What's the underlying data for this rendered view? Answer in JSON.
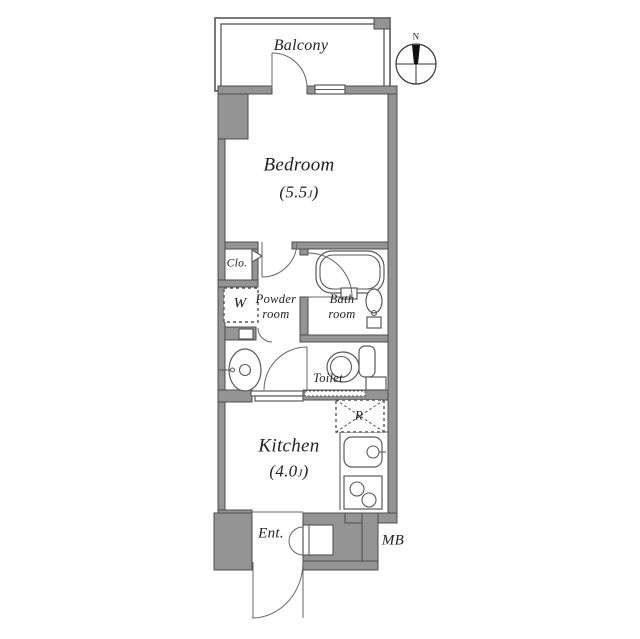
{
  "colors": {
    "wall": "#949494",
    "line": "#4d4d4d",
    "fixture": "#5a5a5a",
    "door": "#666666",
    "text": "#222222",
    "background": "#ffffff"
  },
  "compass": {
    "north_label": "N"
  },
  "rooms": {
    "balcony": {
      "label": "Balcony"
    },
    "bedroom": {
      "label": "Bedroom",
      "size_prefix": "(5.5",
      "size_unit": "J",
      "size_suffix": ")"
    },
    "closet": {
      "label": "Clo."
    },
    "washing_machine": {
      "label": "W"
    },
    "powder_room": {
      "label_line1": "Powder",
      "label_line2": "room"
    },
    "bath_room": {
      "label_line1": "Bath",
      "label_line2": "room"
    },
    "toilet": {
      "label": "Toilet"
    },
    "kitchen": {
      "label": "Kitchen",
      "size_prefix": "(4.0",
      "size_unit": "J",
      "size_suffix": ")"
    },
    "refrigerator": {
      "label": "R"
    },
    "entrance": {
      "label": "Ent."
    },
    "meter_box": {
      "label": "MB"
    }
  }
}
